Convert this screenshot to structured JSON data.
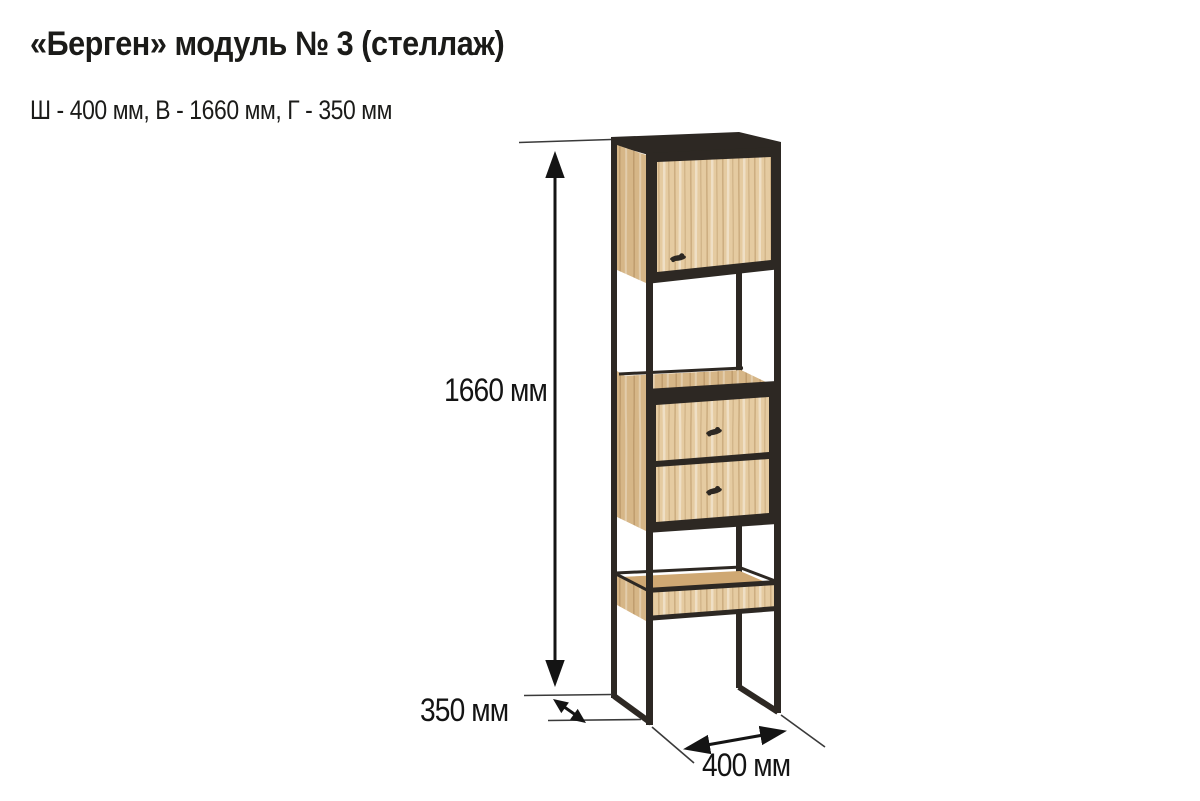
{
  "header": {
    "title": "«Берген» модуль № 3 (стеллаж)",
    "subtitle": "Ш - 400 мм, В - 1660 мм, Г - 350 мм"
  },
  "product": {
    "name": "Берген",
    "module": "модуль № 3",
    "kind": "стеллаж",
    "width_mm": 400,
    "height_mm": 1660,
    "depth_mm": 350
  },
  "dimensions": {
    "height": {
      "value": 1660,
      "unit": "мм",
      "label": "1660 мм"
    },
    "depth": {
      "value": 350,
      "unit": "мм",
      "label": "350 мм"
    },
    "width": {
      "value": 400,
      "unit": "мм",
      "label": "400 мм"
    }
  },
  "colors": {
    "wood": "#e5cba1",
    "wood_side": "#d6b687",
    "wood_shelf": "#cfa873",
    "metal": "#2d2823",
    "dim": "#141414",
    "text": "#1b1b19",
    "background": "#ffffff"
  }
}
